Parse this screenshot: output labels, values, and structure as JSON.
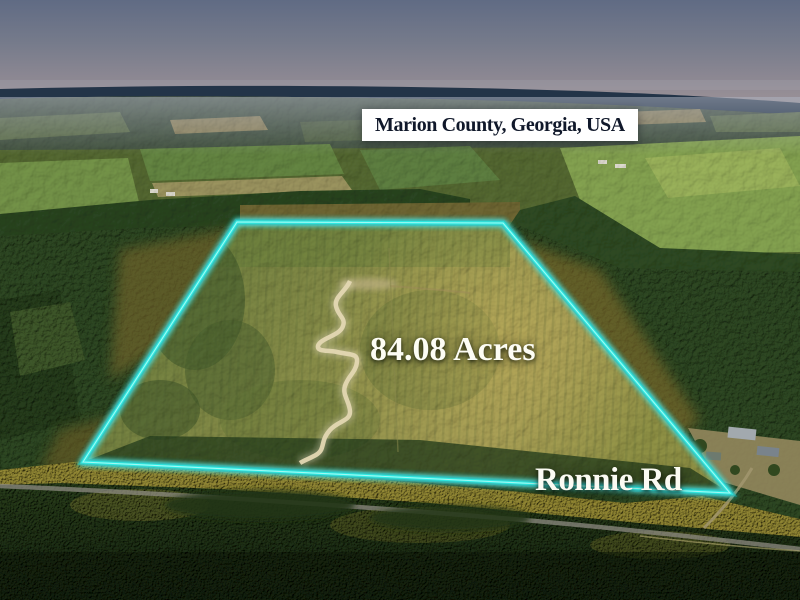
{
  "scene": {
    "description": "aerial drone photo of rural timberland parcel for sale"
  },
  "labels": {
    "location": "Marion County, Georgia, USA",
    "acreage": "84.08 Acres",
    "road": "Ronnie Rd"
  },
  "boundary": {
    "color": "#2FE9E1",
    "points": "237,222 503,223 730,493 83,462"
  },
  "pin": {
    "color": "#D8423C",
    "x": "360",
    "y_top": "106",
    "y_bottom": "297"
  },
  "palette": {
    "sky_top": "#606B84",
    "sky_horizon": "#9A9197",
    "horizon_band": "#233448",
    "parcel_field": "#8A8C48",
    "forest_dark": "#2C4521",
    "sunlit_canopy": "#A9973A",
    "dirt_path": "#E3D7B2",
    "road_gray": "#8E8B81"
  }
}
